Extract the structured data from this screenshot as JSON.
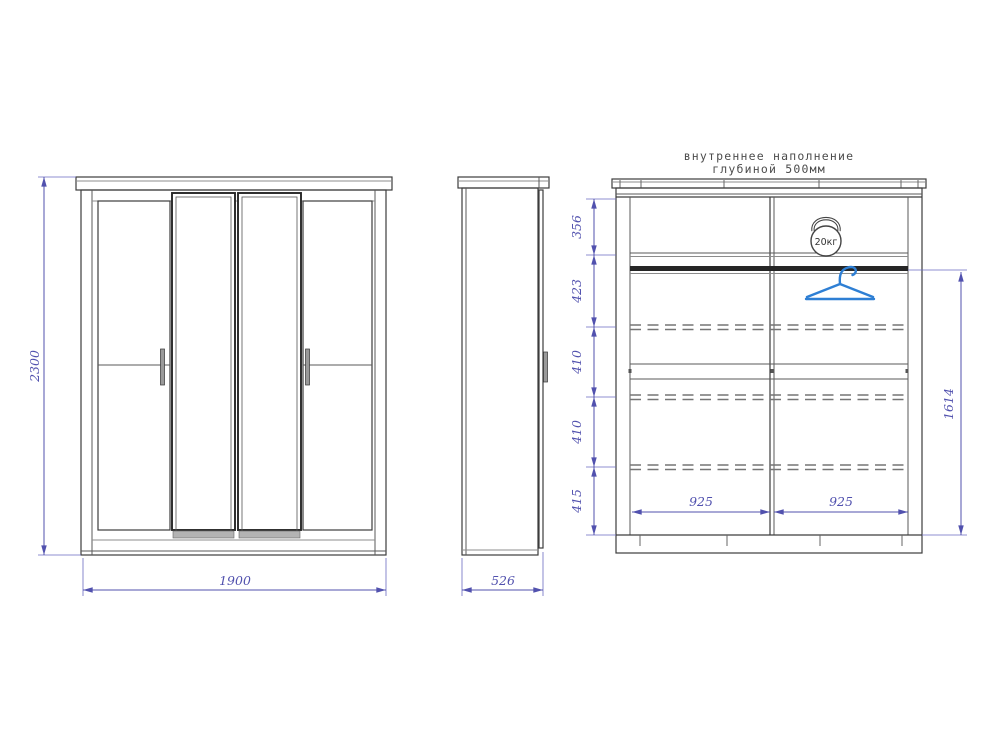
{
  "drawing": {
    "title_line1": "внутреннее наполнение",
    "title_line2": "глубиной 500мм"
  },
  "front_view": {
    "height_mm": "2300",
    "width_mm": "1900"
  },
  "side_view": {
    "depth_mm": "526"
  },
  "internal_view": {
    "section_heights_mm": [
      "356",
      "423",
      "410",
      "410",
      "415"
    ],
    "compartment_widths_mm": [
      "925",
      "925"
    ],
    "hanging_height_mm": "1614",
    "shelf_load_label": "20кг"
  },
  "icons": {
    "weight": "kettlebell-weight-icon",
    "hanger": "clothes-hanger-icon"
  },
  "colors": {
    "dimension": "#5151ae",
    "outline": "#3d3d3d",
    "hanger_blue": "#2e7fd4",
    "background": "#ffffff"
  }
}
